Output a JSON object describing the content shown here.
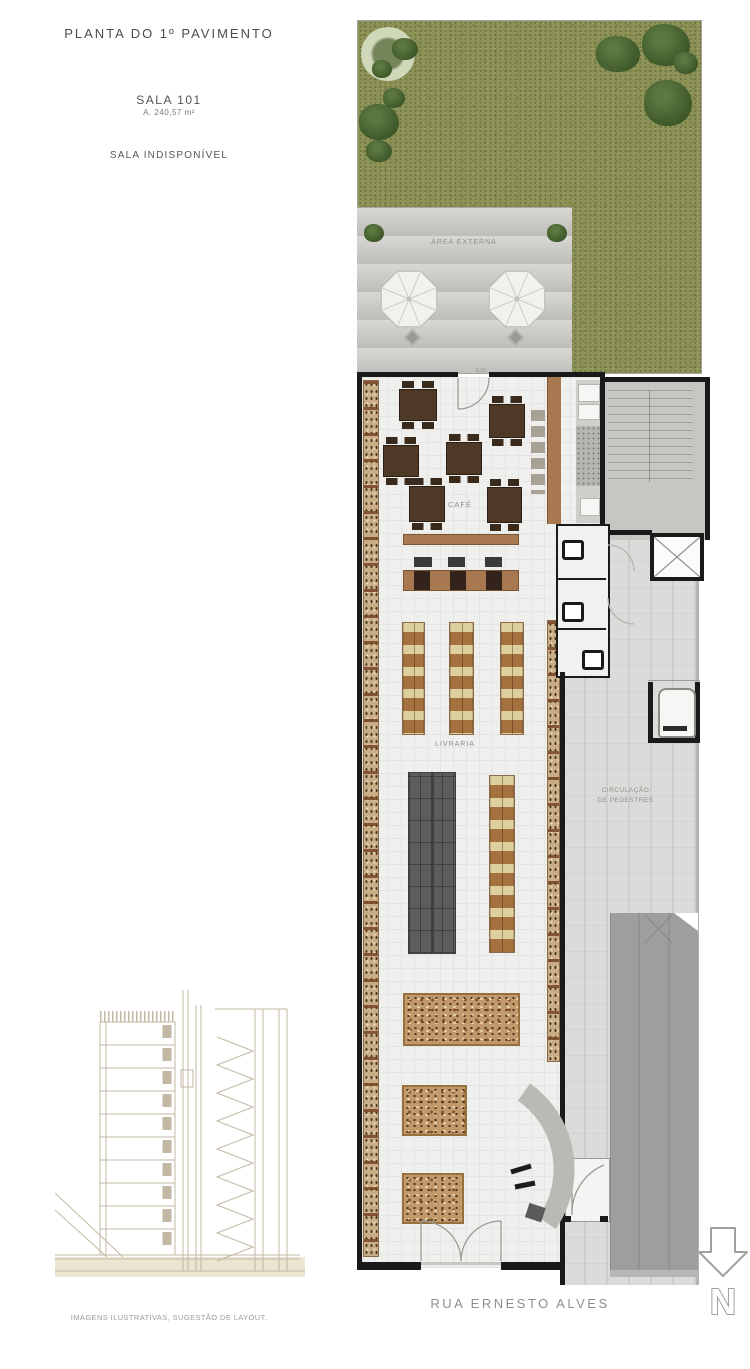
{
  "header": {
    "title": "PLANTA DO 1º PAVIMENTO",
    "room_name": "SALA 101",
    "room_area": "A. 240,57 m²",
    "room_status": "SALA INDISPONÍVEL"
  },
  "plan": {
    "labels": {
      "outdoor_area": "ÁREA EXTERNA",
      "cafe": "CAFÉ",
      "bookstore": "LIVRARIA",
      "pedestrian_line1": "CIRCULAÇÃO",
      "pedestrian_line2": "DE PEDESTRES",
      "top_door_dim": "6,23"
    },
    "street_name": "RUA ERNESTO ALVES",
    "north_label": "N"
  },
  "footer": {
    "disclaimer": "IMAGENS ILUSTRATIVAS, SUGESTÃO DE LAYOUT."
  },
  "colors": {
    "grass": "#8c9156",
    "terrace": "#c7c6c2",
    "floor": "#efefed",
    "wall": "#1a1a1a",
    "wood": "#a87950",
    "shelf_tan": "#d9c690",
    "shelf_brown": "#9c6b45",
    "dark_shelf": "#5d5d5b",
    "circulation": "#dcdbd9",
    "dark_band": "#9e9e9c"
  }
}
